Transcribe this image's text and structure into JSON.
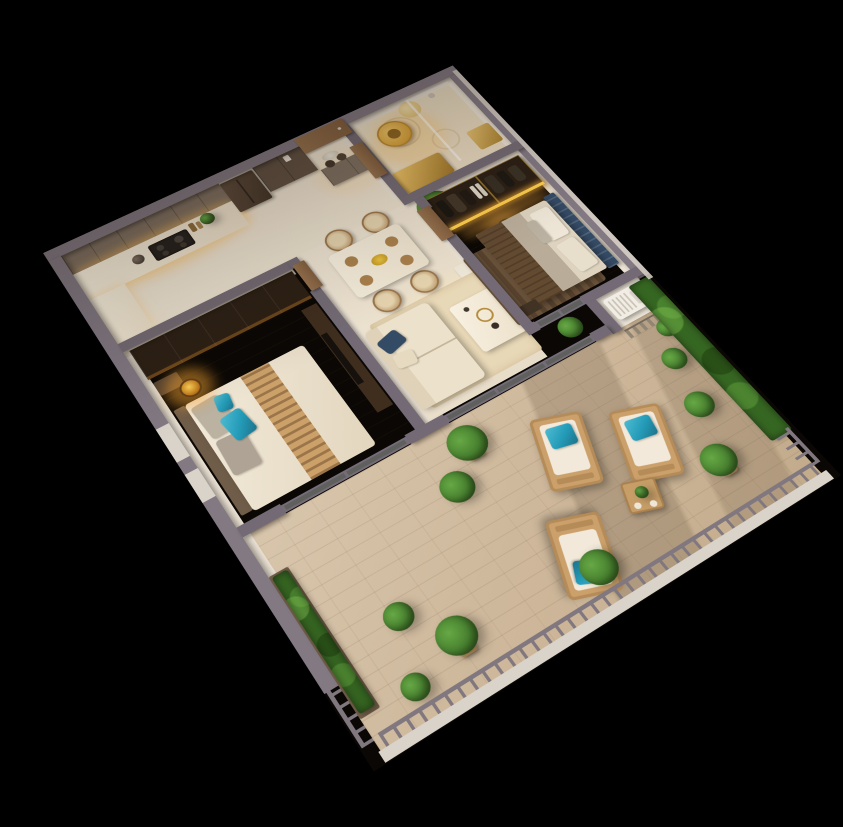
{
  "canvas": {
    "width": 843,
    "height": 827,
    "background": "#000000"
  },
  "colors": {
    "background": "#000000",
    "wall": "#6e6876",
    "wallouter": "#7d7785",
    "walledge": "#9d98a6",
    "whiteband": "#d9d5ce",
    "glassframe": "#6f6a78",
    "rail": "#7c7681",
    "cabinet": "#7b6f63",
    "cabinetdark": "#5a4d42",
    "fridge": "#4a3c31",
    "door": "#8a6748",
    "gold": "#d9a43a",
    "goldlight": "#f1c96b",
    "amber": "#ffb53d",
    "wardrobe": "#241a12",
    "navy": "#2c4766",
    "teal": "#1b9abb",
    "green": "#3f7d2c",
    "greendark": "#2b5a1c",
    "greenlight": "#61a845",
    "hedge": "#2e6420",
    "runner": "#5c462f",
    "rugdark": "#503d2b",
    "rugbeige": "#e7dabb",
    "sofa": "#ece3cf",
    "bedwhite": "#efe9dc",
    "bedgray": "#b9b2a5",
    "ac": "#f2f0ea"
  },
  "scene": {
    "view": "isometric-3d-apartment-floor-plan-render",
    "rooms": [
      {
        "name": "kitchen",
        "items": [
          "upper-cabinets",
          "countertop",
          "cooktop",
          "kettle",
          "refrigerator",
          "tall-cabinet",
          "console-table",
          "vases"
        ]
      },
      {
        "name": "entry-hall",
        "items": [
          "entry-door",
          "light-switch"
        ]
      },
      {
        "name": "bathroom",
        "items": [
          "gold-basin",
          "round-mirror",
          "shower-glass",
          "gold-vanity",
          "shower-fixture",
          "gold-cabinet"
        ]
      },
      {
        "name": "second-bedroom",
        "items": [
          "dark-wardrobe",
          "tv-console",
          "nightstand",
          "double-bed",
          "gray-pillows",
          "teal-pillows",
          "patterned-runner",
          "rattan-pendant-lamp",
          "window"
        ]
      },
      {
        "name": "living-dining",
        "items": [
          "dining-table",
          "wicker-chairs",
          "place-settings",
          "flower-centerpiece",
          "potted-plant",
          "sofa",
          "navy-pillow",
          "coffee-table",
          "beige-rug",
          "wall-bench"
        ]
      },
      {
        "name": "master-bedroom",
        "items": [
          "lit-open-wardrobe",
          "hanging-clothes",
          "pendant-lamp",
          "navy-channel-headboard",
          "double-bed",
          "dark-brown-rug",
          "bench"
        ]
      },
      {
        "name": "balcony-terrace",
        "items": [
          "sliding-glass-doors",
          "lounge-chairs",
          "teal-cushions",
          "wooden-side-table",
          "potted-plants",
          "planter-hedge",
          "vertical-garden-wall",
          "wood-slat-screen",
          "ac-outdoor-unit",
          "metal-railing",
          "white-slab-band"
        ]
      }
    ]
  }
}
